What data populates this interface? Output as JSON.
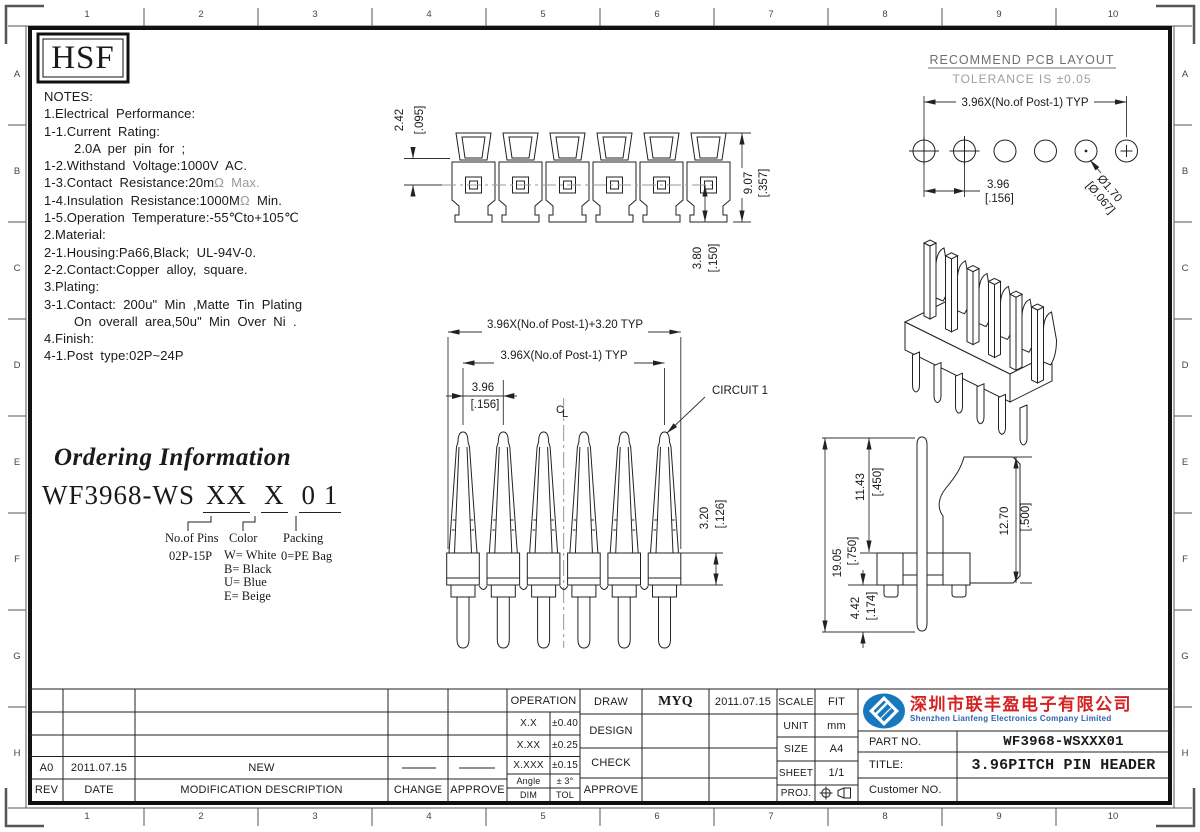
{
  "frame": {
    "numbers": [
      "1",
      "2",
      "3",
      "4",
      "5",
      "6",
      "7",
      "8",
      "9",
      "10"
    ],
    "letters": [
      "A",
      "B",
      "C",
      "D",
      "E",
      "F",
      "G",
      "H"
    ]
  },
  "logo_text": "HSF",
  "notes": {
    "l0": "NOTES:",
    "l1": "1.Electrical Performance:",
    "l2": "1-1.Current Rating:",
    "l3": "2.0A per pin for ;",
    "l4": "1-2.Withstand Voltage:1000V AC.",
    "l5a": "1-3.Contact Resistance:20m",
    "l5b": "Ω Max.",
    "l6a": "1-4.Insulation Resistance:1000M",
    "l6b": "Ω",
    "l6c": " Min.",
    "l7": "1-5.Operation Temperature:-55℃to+105℃",
    "l8": "2.Material:",
    "l9": "2-1.Housing:Pa66,Black; UL-94V-0.",
    "l10": "2-2.Contact:Copper alloy, square.",
    "l11": "3.Plating:",
    "l12": "3-1.Contact: 200u\" Min ,Matte Tin Plating",
    "l13": "On overall area,50u\" Min Over Ni .",
    "l14": "4.Finish:",
    "l15": "4-1.Post type:02P~24P"
  },
  "pcb": {
    "title": "RECOMMEND PCB LAYOUT",
    "subtitle": "TOLERANCE IS ±0.05",
    "dim_span": "3.96X(No.of Post-1) TYP",
    "pitch_mm": "3.96",
    "pitch_in": "[.156]",
    "hole_mm": "Ø1.70",
    "hole_in": "[Ø.067]"
  },
  "front_view": {
    "clip_mm": "2.42",
    "clip_in": "[.095]",
    "height_mm": "9.07",
    "height_in": "[.357]",
    "below_mm": "3.80",
    "below_in": "[.150]"
  },
  "pin_view": {
    "dim_total": "3.96X(No.of Post-1)+3.20 TYP",
    "dim_span": "3.96X(No.of Post-1) TYP",
    "pitch_mm": "3.96",
    "pitch_in": "[.156]",
    "circuit": "CIRCUIT 1",
    "body_mm": "3.20",
    "body_in": "[.126]",
    "cl_c": "C",
    "cl_l": "L"
  },
  "side_view": {
    "upper_mm": "11.43",
    "upper_in": "[.450]",
    "total_mm": "19.05",
    "total_in": "[.750]",
    "lower_mm": "4.42",
    "lower_in": "[.174]",
    "height_mm": "12.70",
    "height_in": "[.500]"
  },
  "ordering": {
    "title": "Ordering Information",
    "base": "WF3968-WS",
    "pins_code": "XX",
    "color_code": "X",
    "packing_code": "0 1",
    "pins_label": "No.of Pins",
    "pins_value": "02P-15P",
    "color_label": "Color",
    "color_options": [
      "W= White",
      "B= Black",
      "U= Blue",
      "E= Beige"
    ],
    "packing_label": "Packing",
    "packing_value": "0=PE Bag"
  },
  "title_block": {
    "operation": "OPERATION",
    "tol": [
      [
        "X.X",
        "±0.40"
      ],
      [
        "X.XX",
        "±0.25"
      ],
      [
        "X.XXX",
        "±0.15"
      ],
      [
        "Angle",
        "± 3°"
      ],
      [
        "DIM",
        "TOL"
      ]
    ],
    "draw": "DRAW",
    "draw_name": "MYQ",
    "draw_date": "2011.07.15",
    "design": "DESIGN",
    "check": "CHECK",
    "approve": "APPROVE",
    "scale": "SCALE",
    "scale_v": "FIT",
    "unit": "UNIT",
    "unit_v": "mm",
    "size": "SIZE",
    "size_v": "A4",
    "sheet": "SHEET",
    "sheet_v": "1/1",
    "proj": "PROJ.",
    "company_cn": "深圳市联丰盈电子有限公司",
    "company_en": "Shenzhen Lianfeng Electronics Company Limited",
    "part_no": "PART NO.",
    "part_no_v": "WF3968-WSXXX01",
    "title": "TITLE:",
    "title_v": "3.96PITCH PIN HEADER",
    "customer": "Customer NO."
  },
  "revision": {
    "rev": "A0",
    "date": "2011.07.15",
    "desc": "NEW",
    "h_rev": "REV",
    "h_date": "DATE",
    "h_desc": "MODIFICATION DESCRIPTION",
    "h_change": "CHANGE",
    "h_approve": "APPROVE"
  }
}
